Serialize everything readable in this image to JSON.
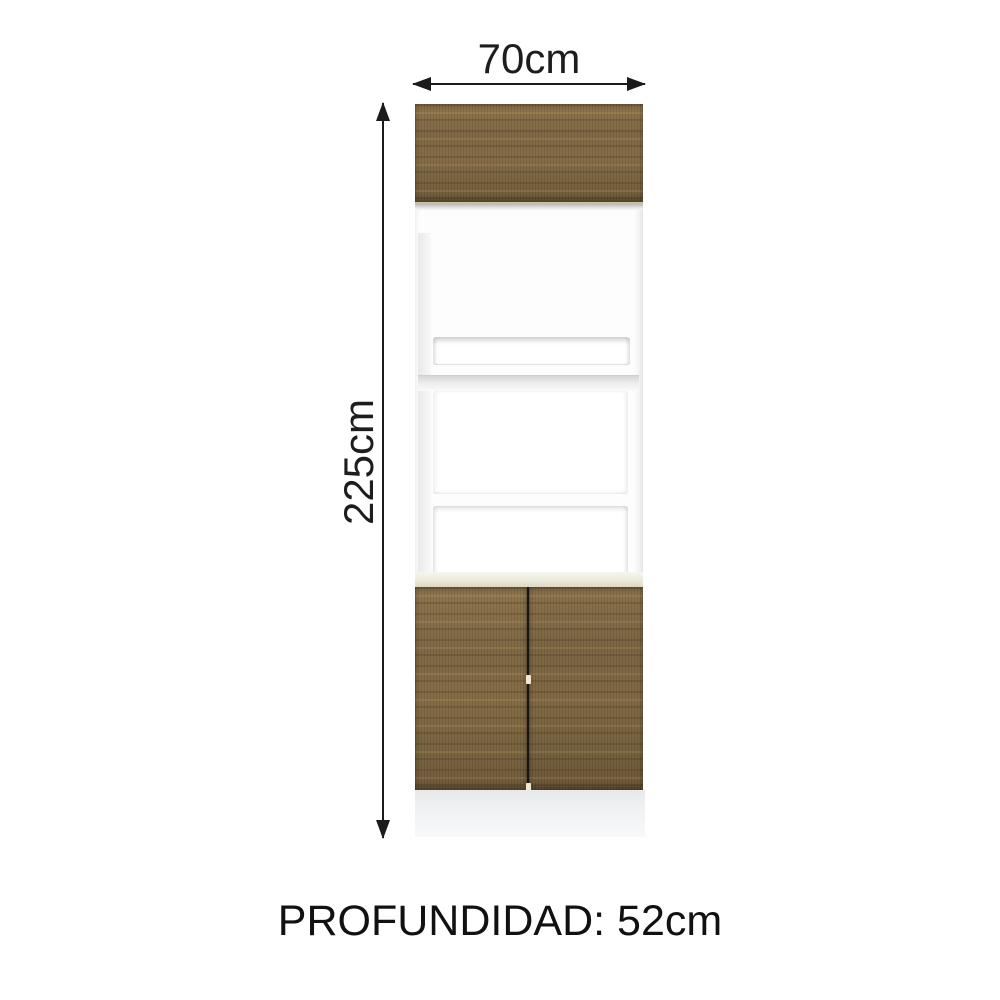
{
  "dimensions": {
    "width": "70cm",
    "height": "225cm",
    "depth": "PROFUNDIDAD: 52cm"
  },
  "cabinet": {
    "parts": {
      "top_door": "wood panel door",
      "niche": "open white frame with slot, middle and large openings",
      "bottom_doors": "two wood panel doors with center gap",
      "plinth": "white base"
    },
    "colors": {
      "background": "#ffffff",
      "arrow": "#1b1b1b",
      "wood_base": "#7c6641",
      "wood_dark_streak": "#4e3a1e",
      "wood_light_streak": "#c4a468",
      "frame_white": "#fdfdfd",
      "frame_shadow": "#d6d6d6",
      "trim_cream": "#ece9db",
      "door_gap": "#161616",
      "hinge_mark": "#efe9d2",
      "plinth_gray": "#e6e8ea"
    }
  }
}
